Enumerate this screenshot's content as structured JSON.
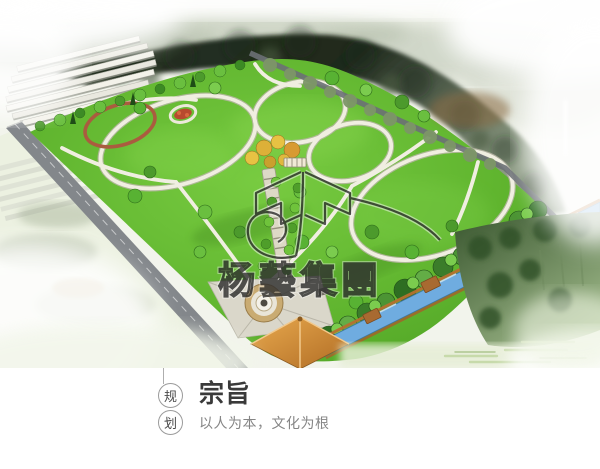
{
  "photo": {
    "name": "park-masterplan-aerial-rendering",
    "watermark": {
      "text": "杨藝集團"
    },
    "palette": {
      "lawn": "#5cb32e",
      "water": "#6face0",
      "roof_orange": "#d9913c",
      "forest_dark": "#27311f",
      "path_light": "#f0eee1",
      "track_red": "#aa5c3f",
      "road_gray": "#83878b"
    }
  },
  "caption": {
    "badge": {
      "top_char": "规",
      "bottom_char": "划"
    },
    "title": "宗旨",
    "subtitle": "以人为本，文化为根"
  }
}
